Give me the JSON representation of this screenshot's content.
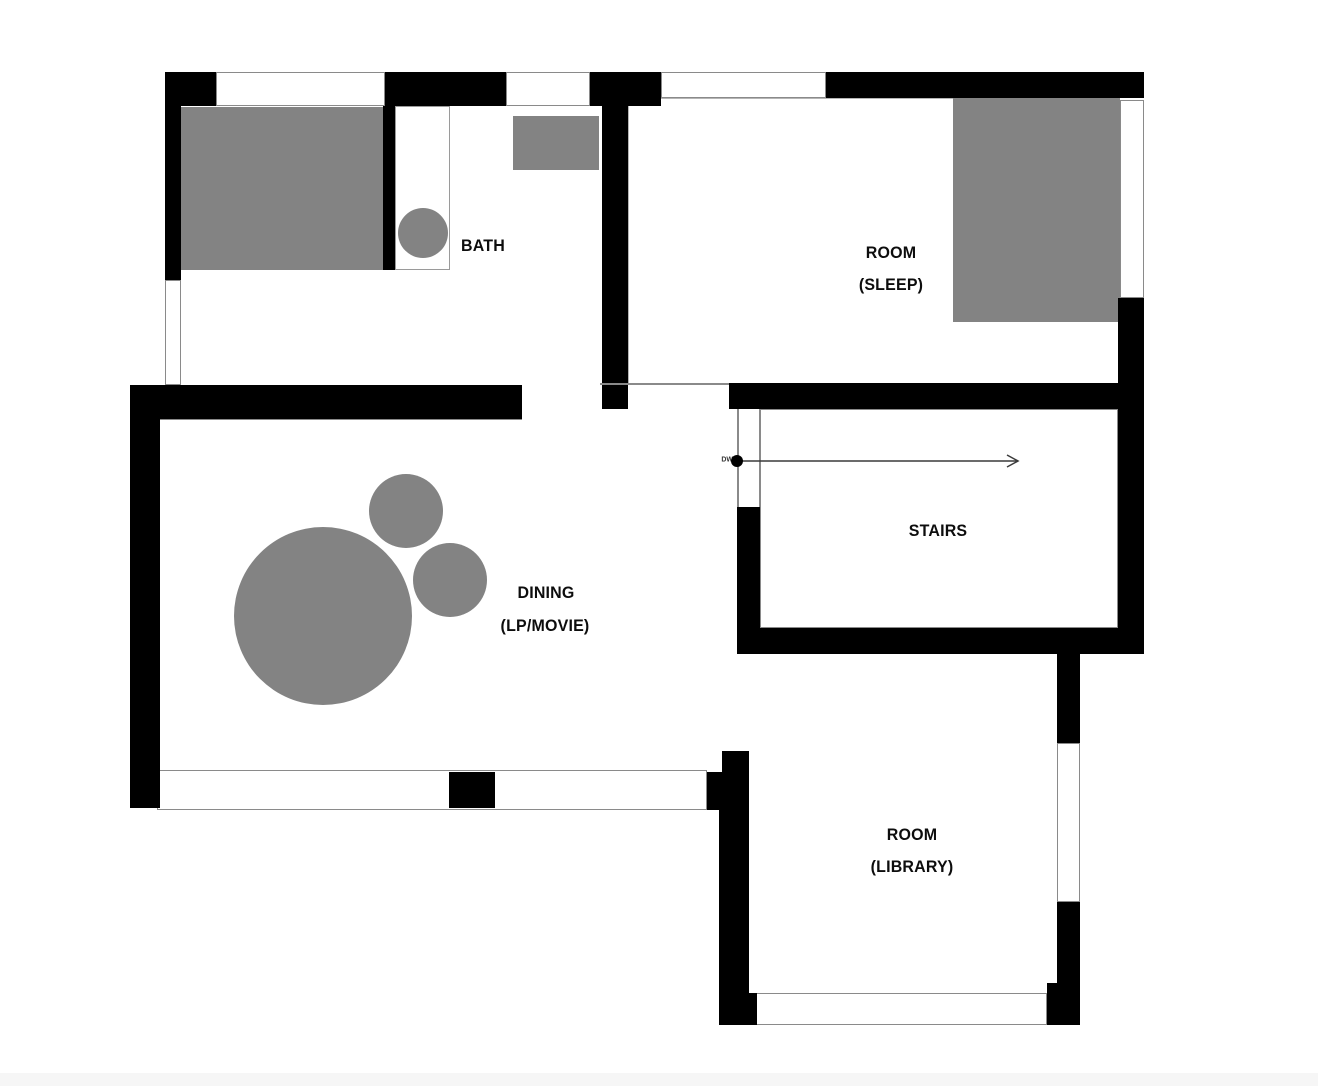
{
  "title": "floor-plan",
  "colors": {
    "wall": "#000000",
    "furniture": "#838383",
    "window_border": "#8a8a8a",
    "label": "#0d0d0d",
    "arrow": "#3a3a3a",
    "bottom_strip": "#f6f6f6"
  },
  "rooms": [
    {
      "id": "bath",
      "lines": [
        "BATH"
      ],
      "positions": [
        [
          483,
          246
        ]
      ]
    },
    {
      "id": "room-sleep",
      "lines": [
        "ROOM",
        "(SLEEP)"
      ],
      "positions": [
        [
          891,
          253
        ],
        [
          891,
          285
        ]
      ]
    },
    {
      "id": "stairs",
      "lines": [
        "STAIRS"
      ],
      "positions": [
        [
          938,
          531
        ]
      ]
    },
    {
      "id": "dining",
      "lines": [
        "DINING",
        "(LP/MOVIE)"
      ],
      "positions": [
        [
          546,
          593
        ],
        [
          545,
          626
        ]
      ]
    },
    {
      "id": "room-library",
      "lines": [
        "ROOM",
        "(LIBRARY)"
      ],
      "positions": [
        [
          912,
          835
        ],
        [
          912,
          867
        ]
      ]
    }
  ],
  "dw": {
    "text": "DW",
    "position": [
      733,
      460
    ]
  },
  "arrow": {
    "name": "stairs-direction-arrow",
    "from": [
      737,
      461
    ],
    "to": [
      1018,
      461
    ],
    "dot_radius": 6
  },
  "geometry": {
    "walls": [
      {
        "name": "outer-wall-top-left-corner",
        "r": [
          165,
          72,
          51,
          34
        ]
      },
      {
        "name": "outer-wall-top-a",
        "r": [
          385,
          72,
          121,
          34
        ]
      },
      {
        "name": "outer-wall-top-b",
        "r": [
          590,
          72,
          71,
          34
        ]
      },
      {
        "name": "outer-wall-top-c",
        "r": [
          826,
          72,
          318,
          26
        ]
      },
      {
        "name": "outer-wall-left-upper",
        "r": [
          165,
          106,
          16,
          174
        ]
      },
      {
        "name": "bath-partition-wall",
        "r": [
          383,
          106,
          12,
          164
        ]
      },
      {
        "name": "sleep-room-left-wall",
        "r": [
          602,
          72,
          26,
          337
        ]
      },
      {
        "name": "sleep-room-bottom-wall",
        "r": [
          729,
          383,
          415,
          26
        ]
      },
      {
        "name": "outer-wall-right",
        "r": [
          1118,
          298,
          26,
          356
        ]
      },
      {
        "name": "stairs-left-wall",
        "r": [
          737,
          507,
          23,
          147
        ]
      },
      {
        "name": "stairs-bottom-wall",
        "r": [
          737,
          628,
          407,
          26
        ]
      },
      {
        "name": "dining-top-wall",
        "r": [
          130,
          385,
          392,
          34
        ]
      },
      {
        "name": "dining-left-wall",
        "r": [
          130,
          385,
          30,
          423
        ]
      },
      {
        "name": "dining-bottom-mullion",
        "r": [
          449,
          772,
          46,
          36
        ]
      },
      {
        "name": "dining-bottom-corner",
        "r": [
          707,
          772,
          42,
          38
        ]
      },
      {
        "name": "library-left-wall-stub",
        "r": [
          722,
          751,
          27,
          23
        ]
      },
      {
        "name": "library-left-wall",
        "r": [
          719,
          810,
          30,
          215
        ]
      },
      {
        "name": "library-bottom-left-corner",
        "r": [
          749,
          993,
          8,
          32
        ]
      },
      {
        "name": "library-right-wall-upper",
        "r": [
          1057,
          654,
          23,
          89
        ]
      },
      {
        "name": "library-right-wall-lower",
        "r": [
          1057,
          902,
          23,
          123
        ]
      },
      {
        "name": "library-bottom-right-corner",
        "r": [
          1047,
          983,
          33,
          42
        ]
      }
    ],
    "windows": [
      {
        "name": "window-top-1",
        "r": [
          216,
          72,
          169,
          34
        ]
      },
      {
        "name": "window-top-2",
        "r": [
          506,
          72,
          84,
          34
        ]
      },
      {
        "name": "window-top-3",
        "r": [
          661,
          72,
          165,
          26
        ]
      },
      {
        "name": "window-left",
        "r": [
          165,
          280,
          16,
          105
        ]
      },
      {
        "name": "window-sleep-right",
        "r": [
          1120,
          100,
          24,
          198
        ]
      },
      {
        "name": "window-library-right",
        "r": [
          1057,
          743,
          23,
          159
        ]
      },
      {
        "name": "window-band-dining-bottom",
        "r": [
          157,
          770,
          550,
          40
        ]
      },
      {
        "name": "window-band-library-bottom",
        "r": [
          749,
          993,
          298,
          32
        ]
      }
    ],
    "outlines": [
      {
        "name": "sleep-room-interior-outline",
        "r": [
          628,
          98,
          492,
          287
        ],
        "c": "#b5b5b5"
      },
      {
        "name": "stairs-interior-outline",
        "r": [
          760,
          409,
          358,
          219
        ],
        "c": "#8a8a8a"
      }
    ],
    "hairlines": [
      {
        "name": "doorway-header-line",
        "r": [
          600,
          383,
          129,
          2
        ]
      },
      {
        "name": "stairs-door-jamb-left",
        "r": [
          737,
          409,
          2,
          98
        ]
      },
      {
        "name": "stairs-door-jamb-right",
        "r": [
          759,
          409,
          2,
          98
        ]
      },
      {
        "name": "dining-top-interior-line",
        "r": [
          160,
          419,
          362,
          1
        ]
      }
    ],
    "furniture_rects": [
      {
        "name": "bath-furniture-rect",
        "r": [
          181,
          107,
          202,
          163
        ]
      },
      {
        "name": "washer-rect",
        "r": [
          513,
          116,
          86,
          54
        ]
      },
      {
        "name": "bed-rect",
        "r": [
          953,
          98,
          167,
          224
        ]
      }
    ],
    "furniture_circles": [
      {
        "name": "dining-table-large",
        "c": [
          323,
          616
        ],
        "radius": 89
      },
      {
        "name": "dining-table-small-top",
        "c": [
          406,
          511
        ],
        "radius": 37
      },
      {
        "name": "dining-table-small-right",
        "c": [
          450,
          580
        ],
        "radius": 37
      }
    ],
    "fixture": {
      "name": "bath-fixture",
      "r": [
        395,
        106,
        55,
        164
      ],
      "circle": {
        "c": [
          423,
          233
        ],
        "radius": 25
      }
    },
    "bottom_strip": {
      "r": [
        0,
        1073,
        1318,
        13
      ]
    }
  }
}
